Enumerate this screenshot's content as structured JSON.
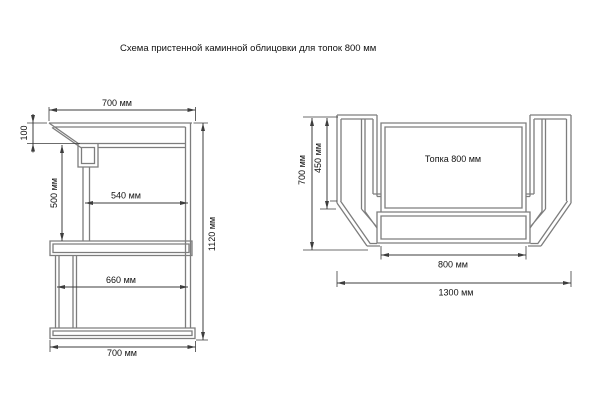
{
  "title": "Схема пристенной каминной облицовки для топок 800 мм",
  "side_view": {
    "name": "Side view of wall fireplace cladding",
    "dims": {
      "top_width": "700 мм",
      "hood_height": "100",
      "opening_height": "500 мм",
      "opening_width": "540 мм",
      "plinth_width": "660 мм",
      "bottom_width": "700 мм",
      "total_height": "1120 мм"
    }
  },
  "plan_view": {
    "name": "Plan view of fireplace portal",
    "firebox_label": "Топка 800 мм",
    "dims": {
      "total_depth": "700 мм",
      "inner_depth": "450 мм",
      "firebox_width": "800 мм",
      "total_width": "1300 мм"
    }
  },
  "colors": {
    "background": "#ffffff",
    "structure_line": "#7d7d7d",
    "dimension_line": "#3d3d3d",
    "label_text": "#111111"
  }
}
